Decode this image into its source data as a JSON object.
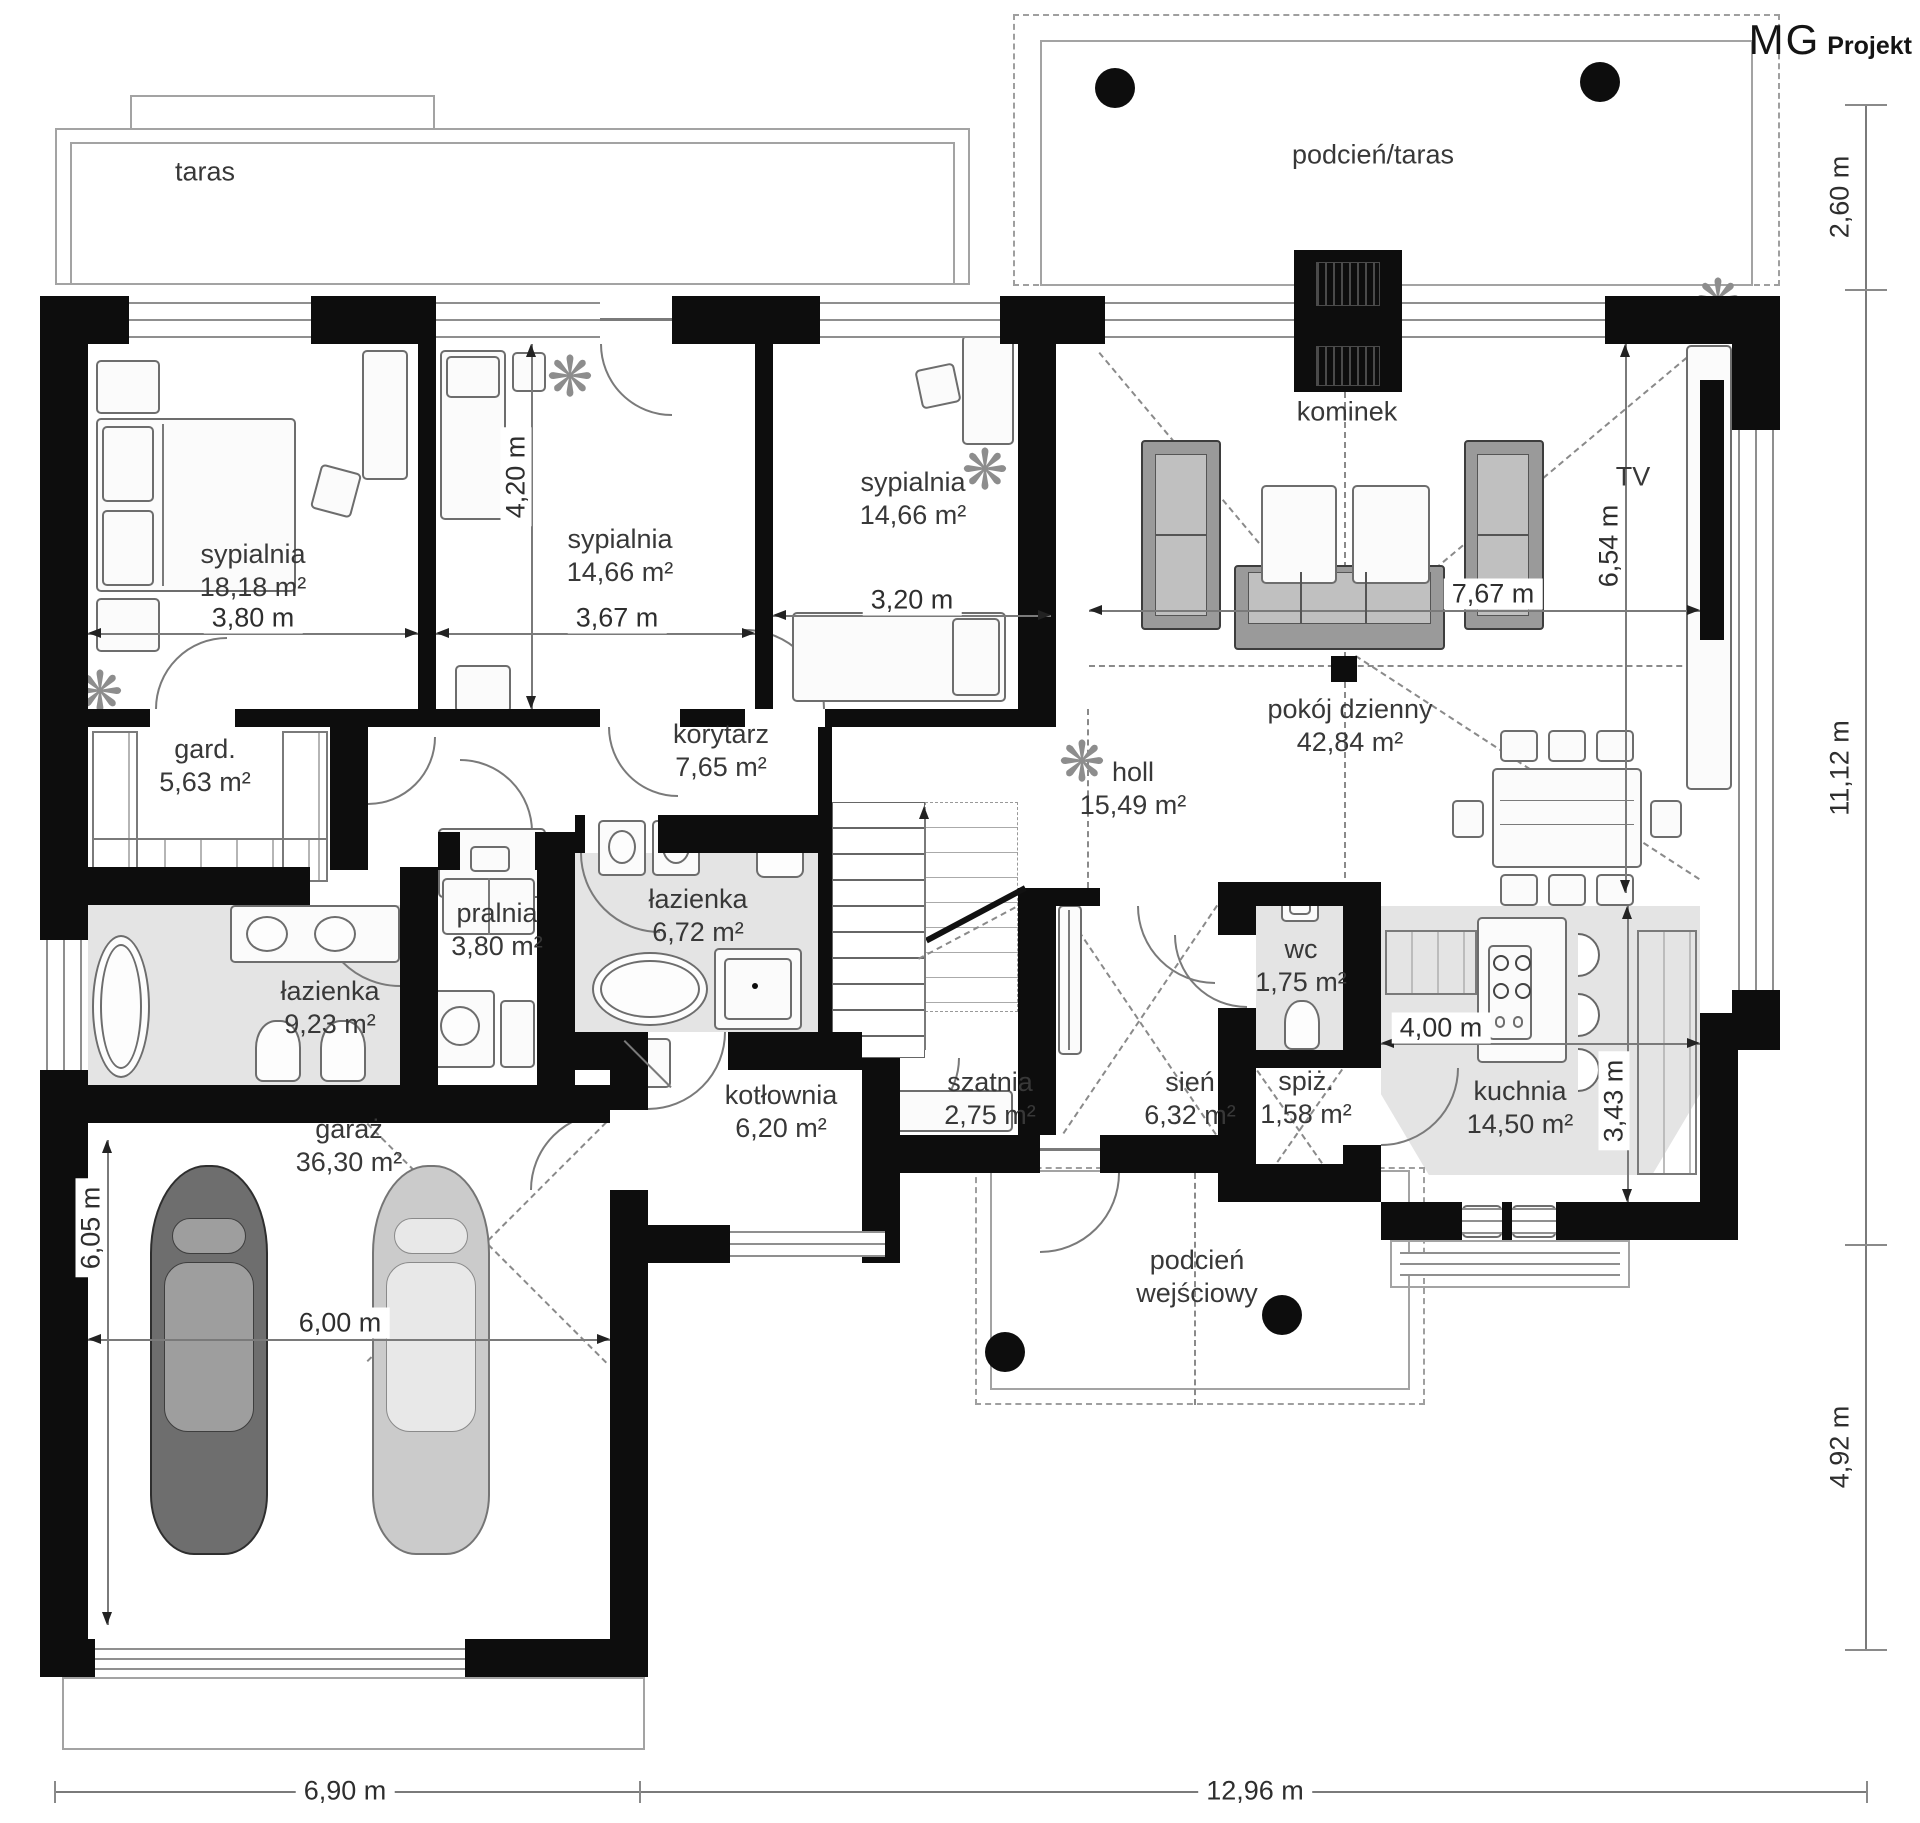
{
  "brand": {
    "mg": "MG",
    "projekt": "Projekt"
  },
  "outdoor": {
    "taras": "taras",
    "podcien_taras": "podcień/taras",
    "kominek": "kominek",
    "tv": "TV",
    "podcien_wejsciowy_1": "podcień",
    "podcien_wejsciowy_2": "wejściowy"
  },
  "rooms": [
    {
      "name": "sypialnia",
      "area": "18,18 m²"
    },
    {
      "name": "sypialnia",
      "area": "14,66 m²"
    },
    {
      "name": "sypialnia",
      "area": "14,66 m²"
    },
    {
      "name": "pokój dzienny",
      "area": "42,84 m²"
    },
    {
      "name": "holl",
      "area": "15,49 m²"
    },
    {
      "name": "korytarz",
      "area": "7,65 m²"
    },
    {
      "name": "gard.",
      "area": "5,63 m²"
    },
    {
      "name": "łazienka",
      "area": "9,23 m²"
    },
    {
      "name": "pralnia",
      "area": "3,80 m²"
    },
    {
      "name": "łazienka",
      "area": "6,72 m²"
    },
    {
      "name": "wc",
      "area": "1,75 m²"
    },
    {
      "name": "spiż.",
      "area": "1,58 m²"
    },
    {
      "name": "kuchnia",
      "area": "14,50 m²"
    },
    {
      "name": "kotłownia",
      "area": "6,20 m²"
    },
    {
      "name": "szatnia",
      "area": "2,75 m²"
    },
    {
      "name": "sień",
      "area": "6,32 m²"
    },
    {
      "name": "garaż",
      "area": "36,30 m²"
    }
  ],
  "dims": {
    "bed1_w": "3,80 m",
    "bed2_h": "4,20 m",
    "bed2_w": "3,67 m",
    "bed3_w": "3,20 m",
    "living_w": "7,67 m",
    "living_h": "6,54 m",
    "kitchen_w": "4,00 m",
    "kitchen_h": "3,43 m",
    "garage_h": "6,05 m",
    "garage_w": "6,00 m",
    "right_top": "2,60 m",
    "right_mid": "11,12 m",
    "right_bottom": "4,92 m",
    "bottom_left": "6,90 m",
    "bottom_right": "12,96 m"
  }
}
